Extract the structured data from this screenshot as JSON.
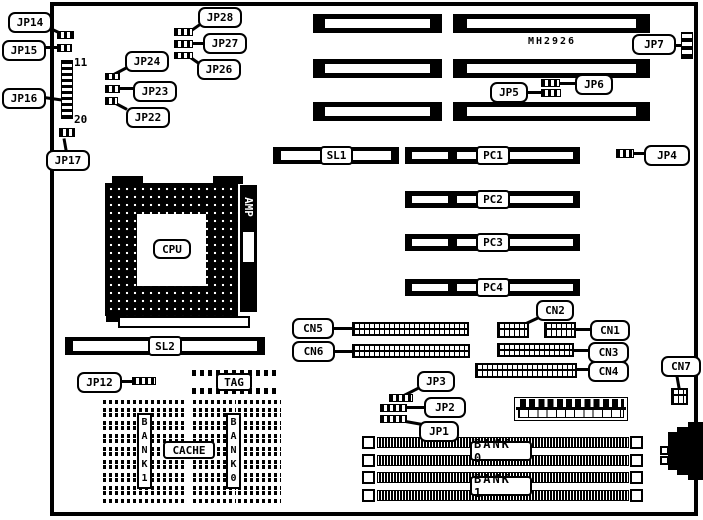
{
  "board": {
    "chip_label": "MH2926"
  },
  "callouts": {
    "jp1": "JP1",
    "jp2": "JP2",
    "jp3": "JP3",
    "jp4": "JP4",
    "jp5": "JP5",
    "jp6": "JP6",
    "jp7": "JP7",
    "jp12": "JP12",
    "jp14": "JP14",
    "jp15": "JP15",
    "jp16": "JP16",
    "jp17": "JP17",
    "jp22": "JP22",
    "jp23": "JP23",
    "jp24": "JP24",
    "jp26": "JP26",
    "jp27": "JP27",
    "jp28": "JP28",
    "cn1": "CN1",
    "cn2": "CN2",
    "cn3": "CN3",
    "cn4": "CN4",
    "cn5": "CN5",
    "cn6": "CN6",
    "cn7": "CN7"
  },
  "slots": {
    "sl1": "SL1",
    "sl2": "SL2",
    "pc1": "PC1",
    "pc2": "PC2",
    "pc3": "PC3",
    "pc4": "PC4"
  },
  "components": {
    "cpu": "CPU",
    "amp": "AMP",
    "tag": "TAG",
    "cache": "CACHE",
    "cache_bank1": "BANK1",
    "cache_bank0": "BANK0",
    "simm_bank0": "BANK 0",
    "simm_bank1": "BANK 1"
  },
  "pins": {
    "jp16_top": "11",
    "jp16_bottom": "20"
  }
}
